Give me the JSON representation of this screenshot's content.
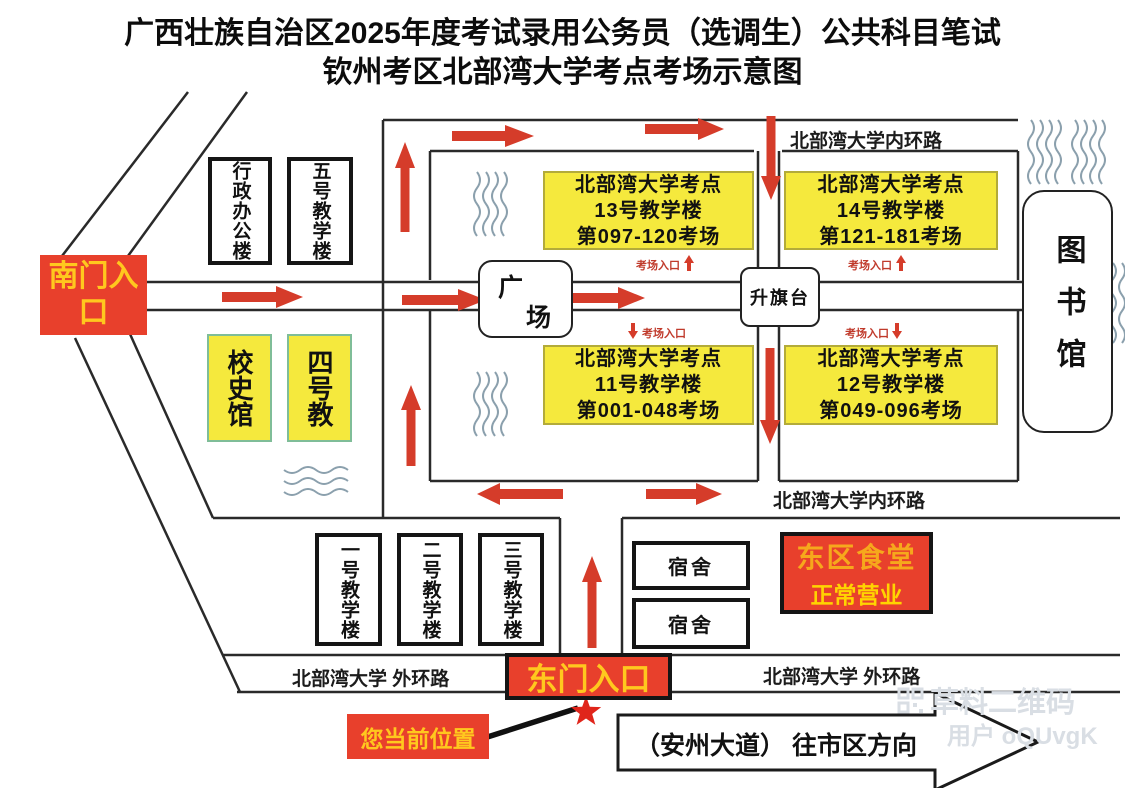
{
  "title": {
    "line1": "广西壮族自治区2025年度考试录用公务员（选调生）公共科目笔试",
    "line2": "钦州考区北部湾大学考点考场示意图"
  },
  "colors": {
    "entrance_red": "#e8402c",
    "label_yellow": "#ffc81e",
    "building_yellow": "#f5e93d",
    "arrow_red": "#d53c2a",
    "road_black": "#2a2a2a",
    "wave_gray": "#8ba0ad"
  },
  "entrances": {
    "south": "南门入口",
    "east": "东门入口",
    "exam_gate": "考场入口"
  },
  "roads": {
    "inner_ring_top": "北部湾大学内环路",
    "inner_ring_bottom": "北部湾大学内环路",
    "outer_ring_left": "北部湾大学 外环路",
    "outer_ring_right": "北部湾大学 外环路",
    "avenue": "（安州大道） 往市区方向"
  },
  "buildings": {
    "admin": "行政办公楼",
    "teach5": "五号教学楼",
    "history_hall": "校史馆",
    "teach4": "四号教",
    "plaza_c1": "广",
    "plaza_c2": "场",
    "flag_stand": "升旗台",
    "library": "图书馆",
    "teach1": "一号教学楼",
    "teach2": "二号教学楼",
    "teach3": "三号教学楼",
    "dorm": "宿舍",
    "canteen_line1": "东区食堂",
    "canteen_line2": "正常营业"
  },
  "exam_buildings": [
    {
      "site": "北部湾大学考点",
      "building": "13号教学楼",
      "rooms": "第097-120考场"
    },
    {
      "site": "北部湾大学考点",
      "building": "14号教学楼",
      "rooms": "第121-181考场"
    },
    {
      "site": "北部湾大学考点",
      "building": "11号教学楼",
      "rooms": "第001-048考场"
    },
    {
      "site": "北部湾大学考点",
      "building": "12号教学楼",
      "rooms": "第049-096考场"
    }
  ],
  "markers": {
    "current_location": "您当前位置"
  },
  "watermark": {
    "brand": "草料二维码",
    "user": "用户 oQUvgK"
  }
}
